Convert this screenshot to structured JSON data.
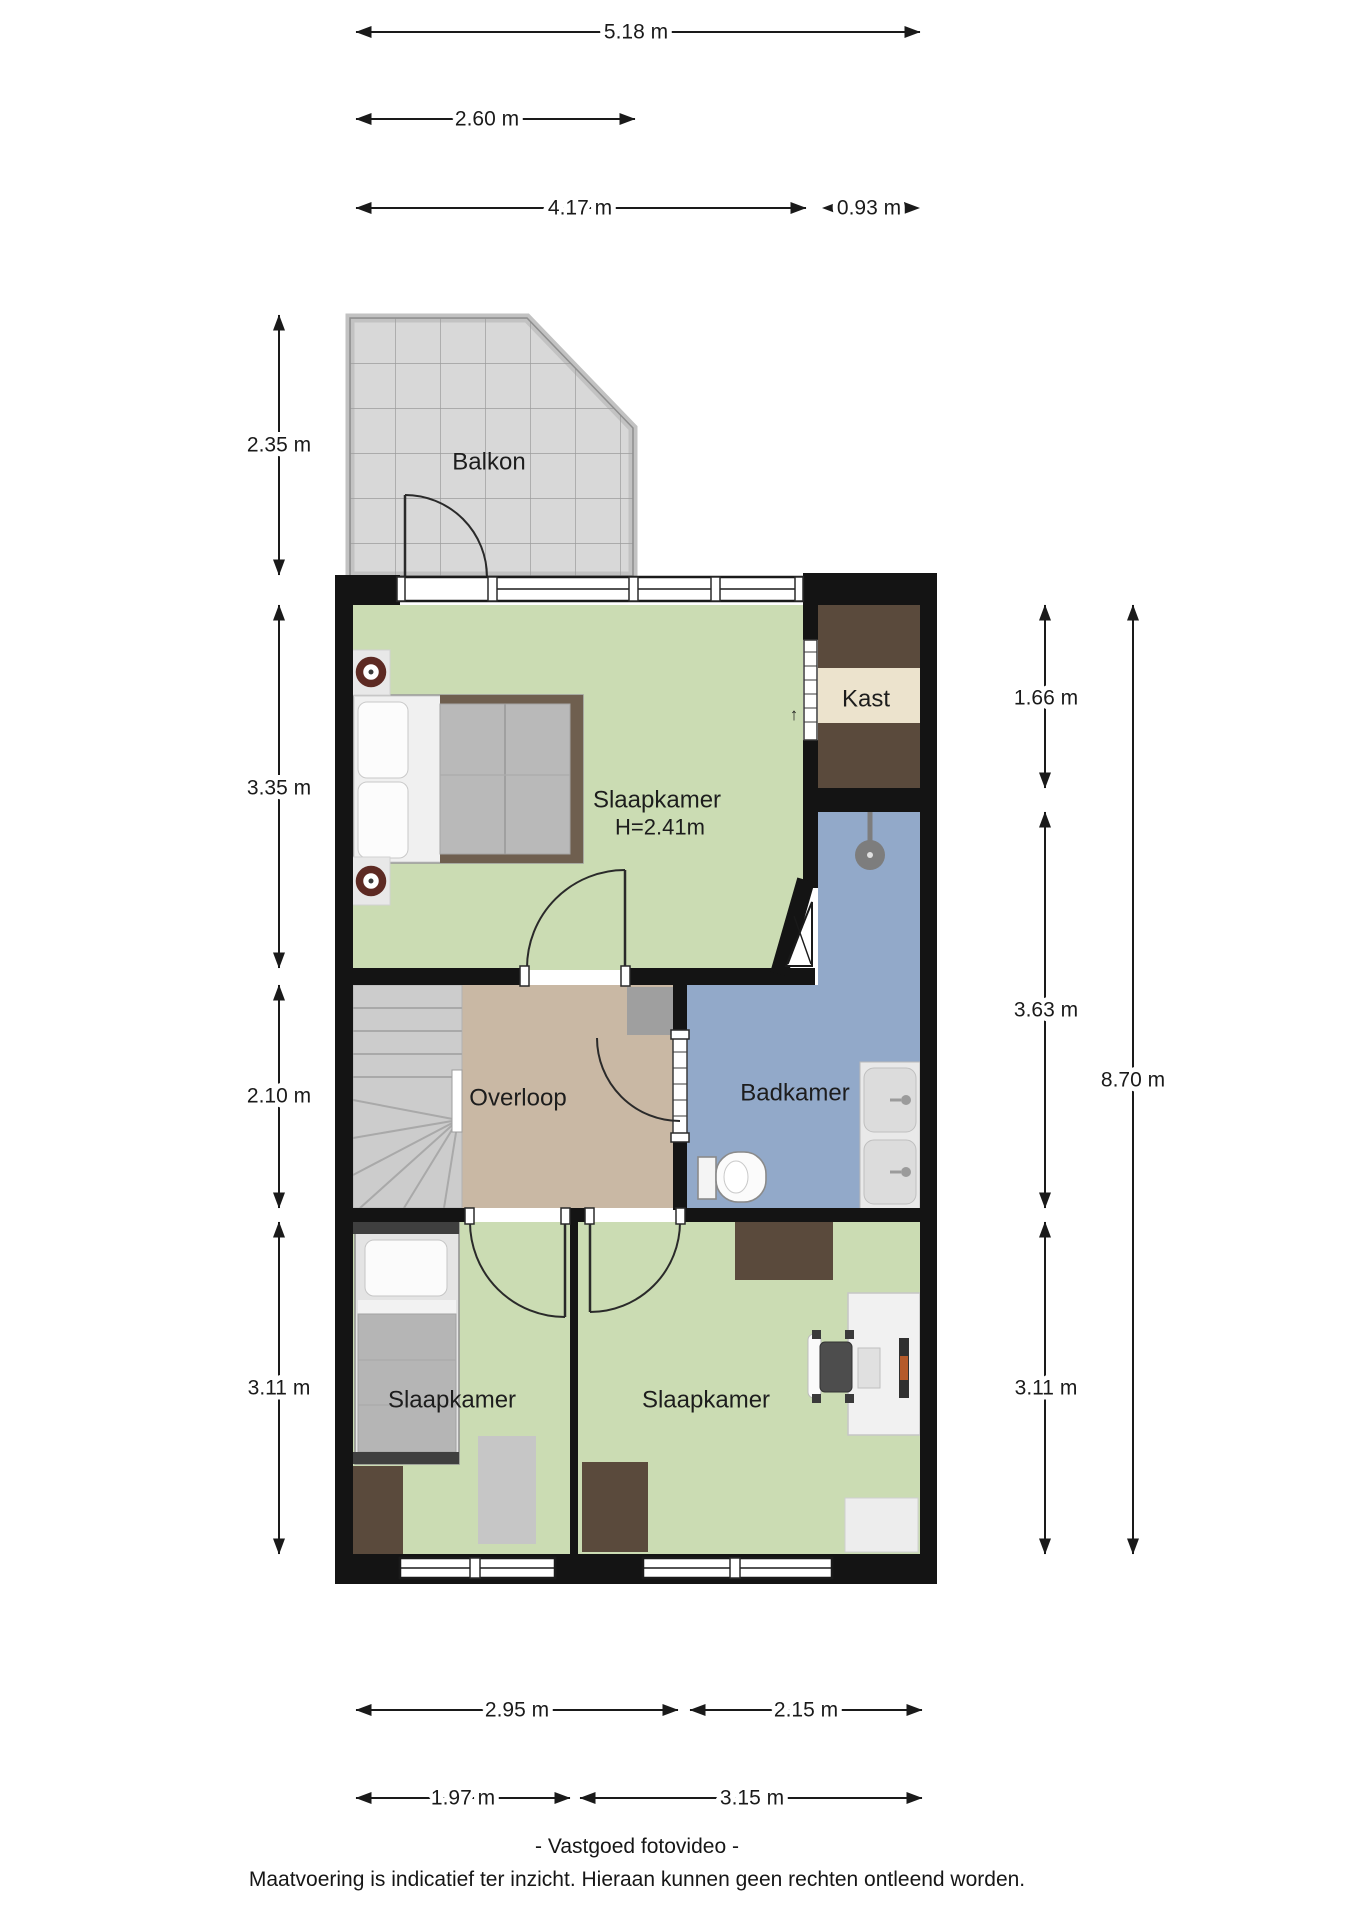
{
  "rooms": {
    "balkon": {
      "label": "Balkon"
    },
    "bedroom_main": {
      "label": "Slaapkamer",
      "height": "H=2.41m"
    },
    "kast": {
      "label": "Kast"
    },
    "overloop": {
      "label": "Overloop"
    },
    "badkamer": {
      "label": "Badkamer"
    },
    "bedroom_left": {
      "label": "Slaapkamer"
    },
    "bedroom_right": {
      "label": "Slaapkamer"
    }
  },
  "dimensions": {
    "top_total": "5.18 m",
    "top_balcony": "2.60 m",
    "top_bedroom": "4.17 m",
    "top_kast": "0.93 m",
    "left_balcony": "2.35 m",
    "left_bedroom": "3.35 m",
    "left_overloop": "2.10 m",
    "left_bedrooms": "3.11 m",
    "right_kast": "1.66 m",
    "right_badkamer": "3.63 m",
    "right_bedroom": "3.11 m",
    "right_total": "8.70 m",
    "bottom_overloop": "2.95 m",
    "bottom_badkamer": "2.15 m",
    "bottom_bedroom_left": "1.97 m",
    "bottom_bedroom_right": "3.15 m"
  },
  "annotations": {
    "kast_door_arrow": "↑"
  },
  "footer": {
    "line1": "- Vastgoed fotovideo -",
    "line2": "Maatvoering is indicatief ter inzicht. Hieraan kunnen geen rechten ontleend worden."
  },
  "colors": {
    "wall": "#141414",
    "bedroom_green": "#cbdcb3",
    "bathroom_blue": "#92a9c9",
    "landing_tan": "#c9b8a4",
    "balcony_gray": "#d8d8d8",
    "closet_dark_brown": "#5a4a3c",
    "closet_cream": "#ece3cd",
    "furniture_brown": "#5a4a3c",
    "stairs_gray": "#cccccc"
  }
}
